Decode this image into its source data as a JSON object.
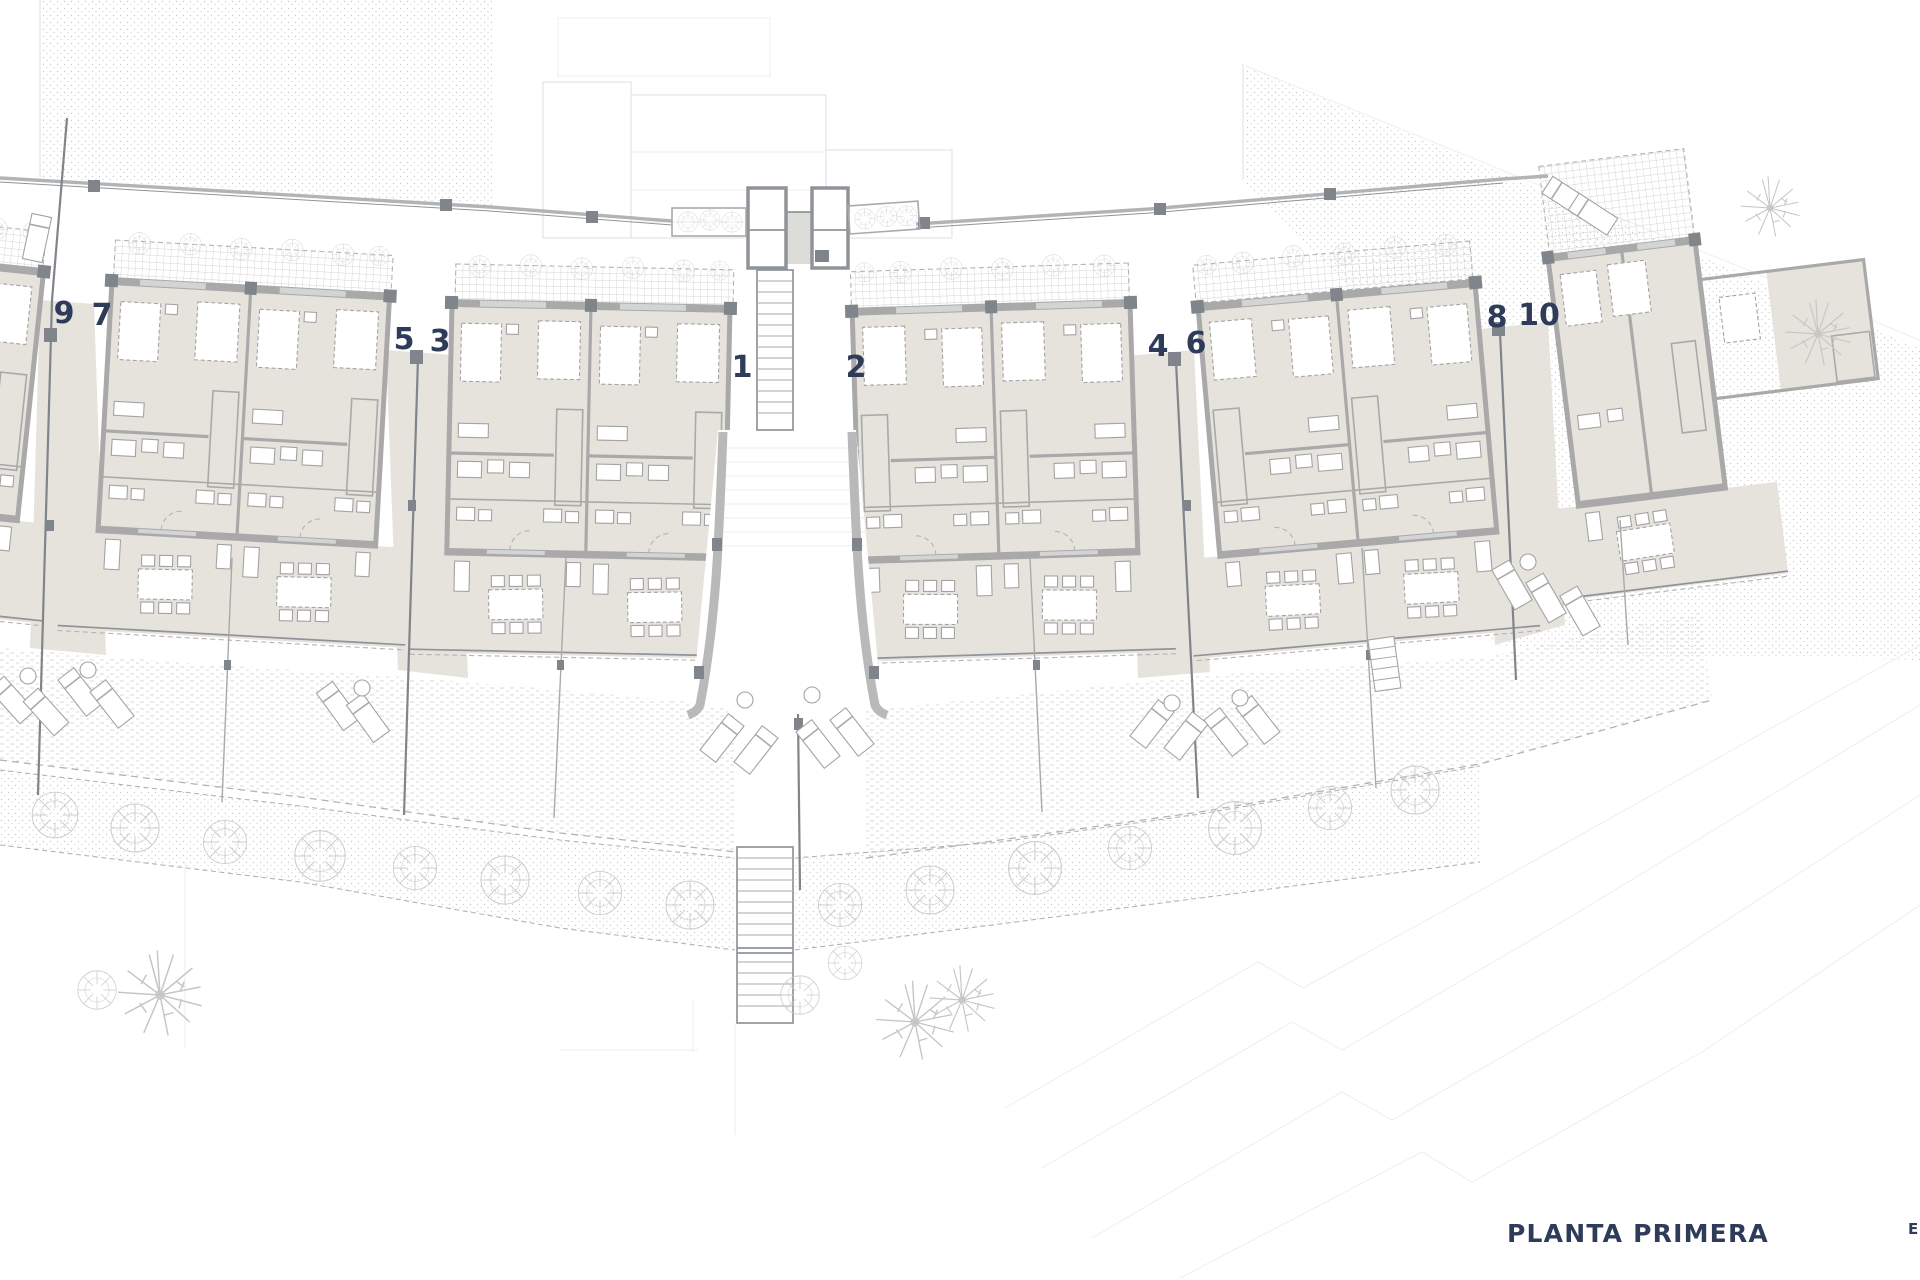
{
  "plan": {
    "title": "PLANTA PRIMERA",
    "edge_label": "E"
  },
  "units": [
    {
      "label": "9"
    },
    {
      "label": "7"
    },
    {
      "label": "5"
    },
    {
      "label": "3"
    },
    {
      "label": "1"
    },
    {
      "label": "2"
    },
    {
      "label": "4"
    },
    {
      "label": "6"
    },
    {
      "label": "8"
    },
    {
      "label": "10"
    }
  ],
  "colors": {
    "floor": "#e6e3dc",
    "wall": "#a9a9a9",
    "walldark": "#8f9499",
    "post": "#7f858a",
    "furn": "#a3a3a3",
    "dash": "#b3b3b3",
    "tree": "#cdcdcd",
    "palm": "#c6c6c6",
    "faint": "#e2e2e2",
    "court": "#dcdcd8",
    "hatch": "#b8b8b8",
    "grid": "#c7c7c7",
    "dots": "#cbcbcb",
    "grass": "#dcdad2",
    "navy": "#2e3c5a"
  }
}
